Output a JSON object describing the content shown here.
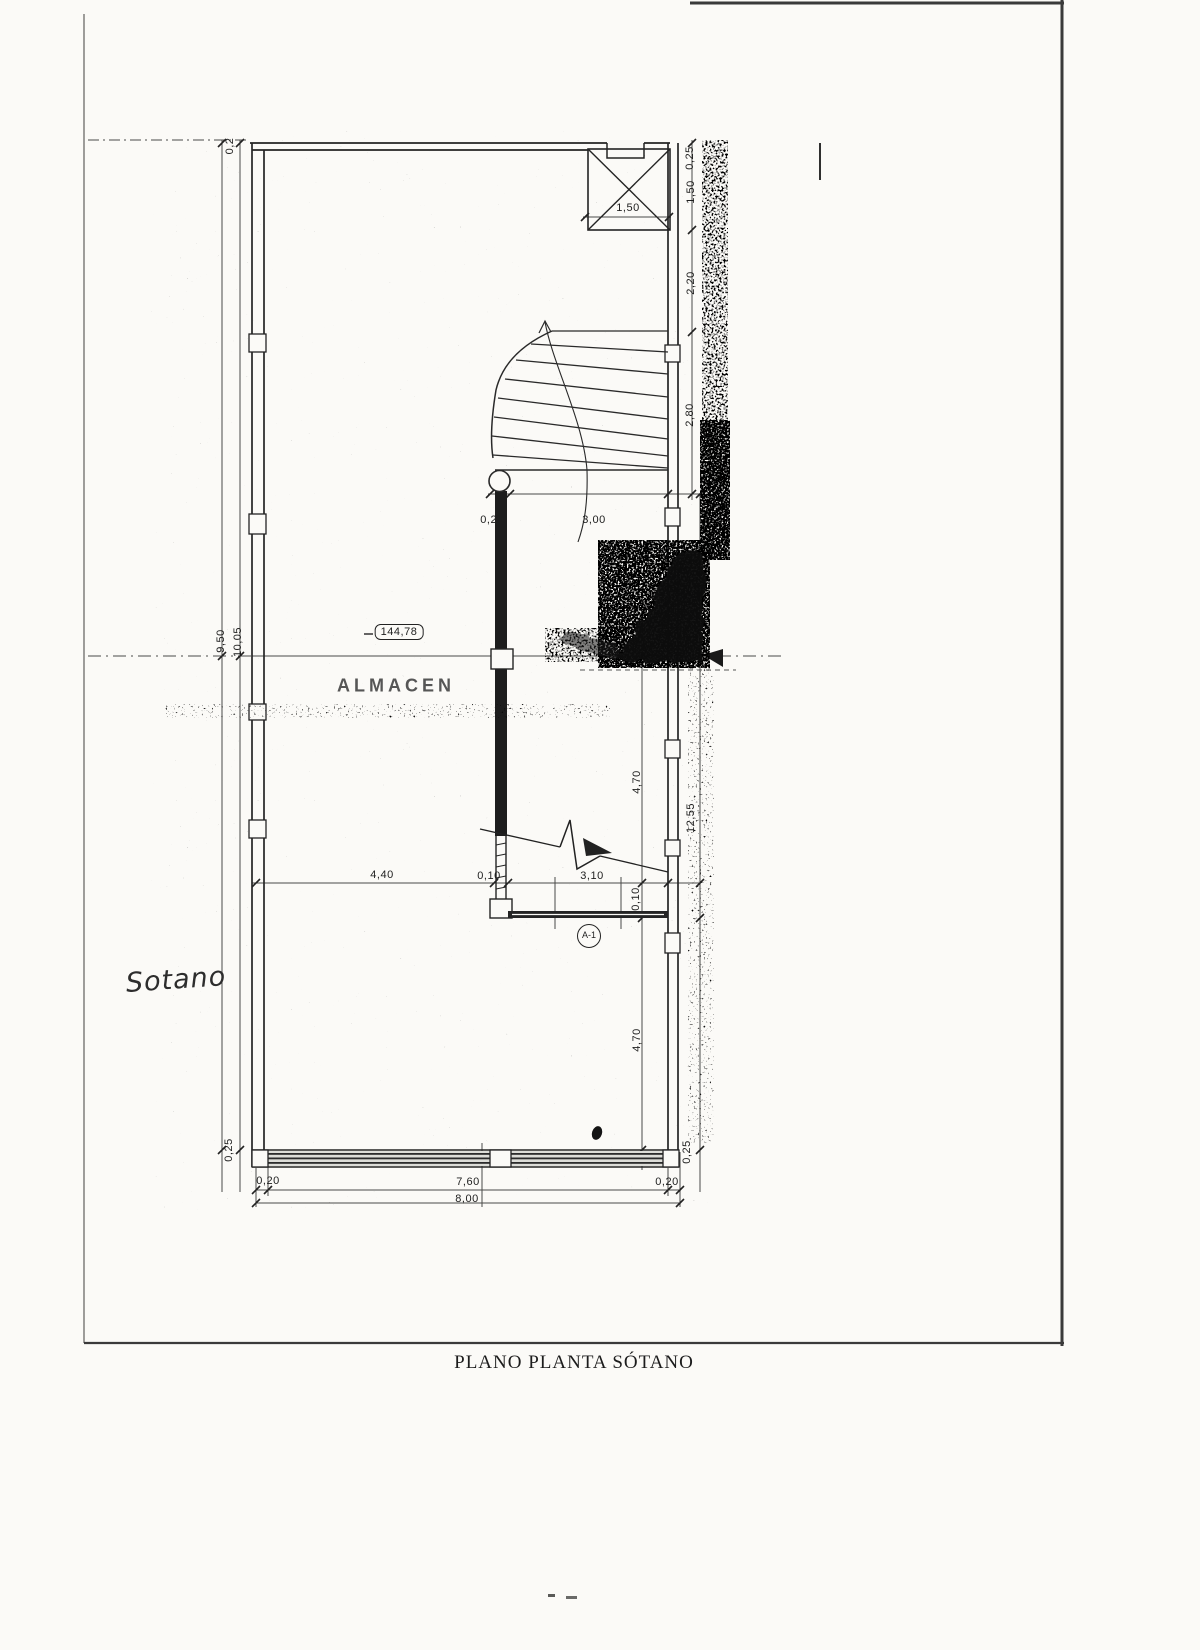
{
  "title_block": {
    "title": "PLANO PLANTA SÓTANO"
  },
  "plan": {
    "room_label": "ALMACEN",
    "area_badge": "144,78",
    "handwritten_note": "Sotano",
    "stair_marker": "A-1"
  },
  "dimensions": {
    "d_top_wall": "0,2",
    "d_r_025_top": "0,25",
    "d_box_150": "1,50",
    "d_r_150": "1,50",
    "d_r_220": "2,20",
    "d_r_280": "2,80",
    "d_st_020": "0,20",
    "d_st_300": "3,00",
    "d_l_950": "9,50",
    "d_l_1005": "10,05",
    "d_m_440": "4,40",
    "d_m_010": "0,10",
    "d_m_310": "3,10",
    "d_r_470a": "4,70",
    "d_r_010": "0,10",
    "d_r_1255": "12,55",
    "d_r_470b": "4,70",
    "d_l_025_bot": "0,25",
    "d_r_025_bot": "0,25",
    "d_b_020l": "0,20",
    "d_b_760": "7,60",
    "d_b_020r": "0,20",
    "d_b_800": "8,00"
  },
  "colors": {
    "paper": "#fbfaf7",
    "ink": "#2b2b2b",
    "noise": "#0e0e0e"
  }
}
